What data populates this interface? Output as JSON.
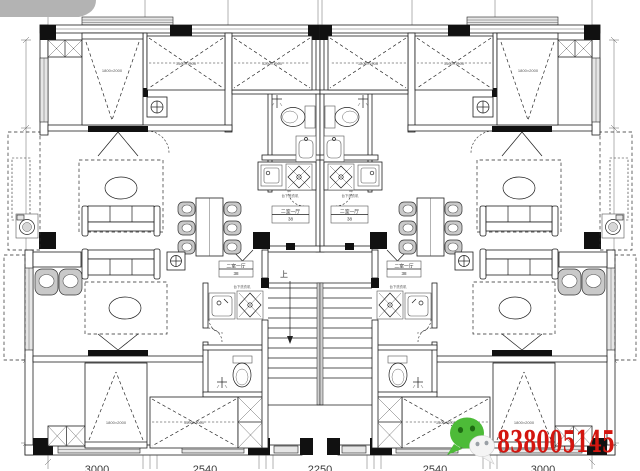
{
  "watermark": {
    "wechat_id": "838005145",
    "color": "#d3150f",
    "icon": "wechat-icon"
  },
  "plan": {
    "stair_direction_label": "上",
    "labels": {
      "bed_corner_top": "1800×2000",
      "bed_mid_top": "1500×1900",
      "bed_inner_top": "1200×1900",
      "bed_corner_bottom": "1800×2000",
      "bed_mid_bottom": "1500×2000",
      "kitchen_note": "台下洗衣机",
      "unit_tag_line1": "二室一厅",
      "unit_tag_line2": "38"
    },
    "dimensions": {
      "bottom": [
        "3000",
        "2540",
        "2250",
        "2540",
        "3000"
      ]
    }
  }
}
